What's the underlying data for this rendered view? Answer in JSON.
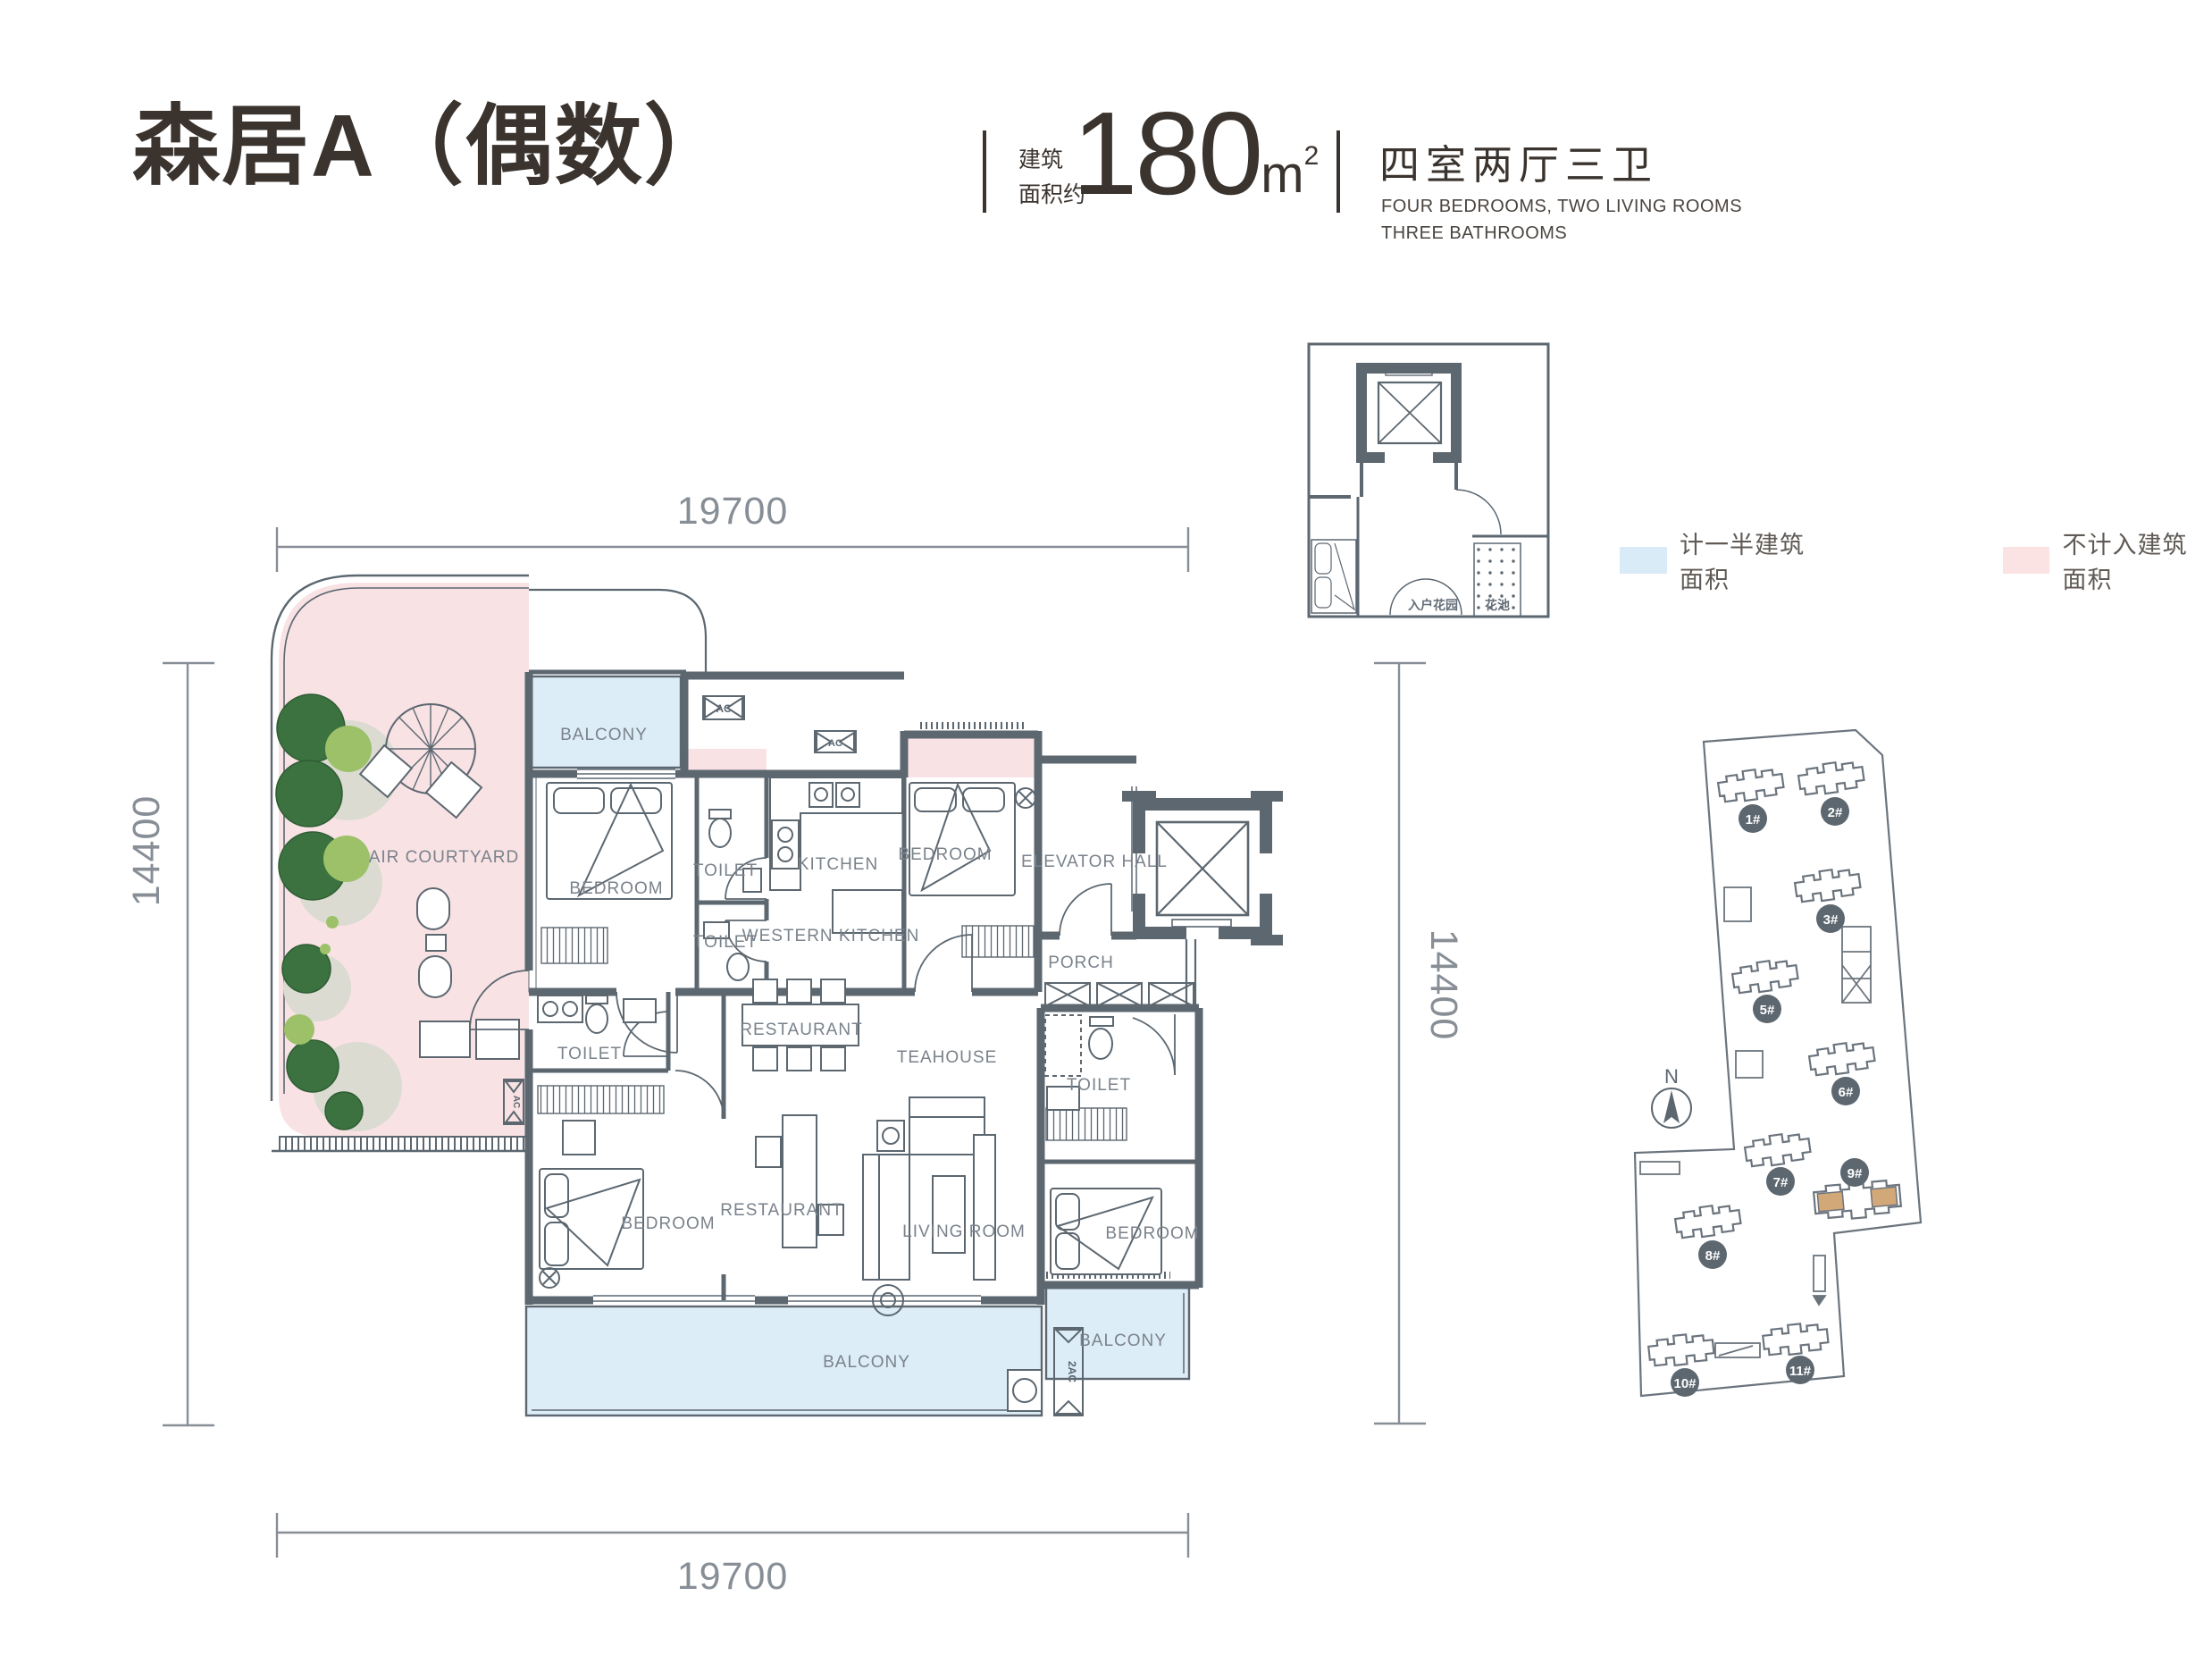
{
  "header": {
    "title": "森居A（偶数）",
    "area_label_line1": "建筑",
    "area_label_line2": "面积约",
    "area_value": "180",
    "area_unit": "m",
    "area_exponent": "2",
    "layout_cn": "四室两厅三卫",
    "layout_en_line1": "FOUR BEDROOMS, TWO LIVING ROOMS",
    "layout_en_line2": "THREE BATHROOMS"
  },
  "legend": {
    "half_area": {
      "label": "计一半建筑面积",
      "color": "#d9ebf7"
    },
    "excluded_area": {
      "label": "不计入建筑面积",
      "color": "#fbe3e4"
    }
  },
  "dimensions": {
    "top": "19700",
    "bottom": "19700",
    "left": "14400",
    "right": "14400"
  },
  "plan": {
    "balcony": "BALCONY",
    "air_courtyard": "AIR COURTYARD",
    "bedroom": "BEDROOM",
    "toilet": "TOILET",
    "kitchen": "KITCHEN",
    "western_kitchen": "WESTERN KITCHEN",
    "elevator_hall": "ELEVATOR HALL",
    "porch": "PORCH",
    "restaurant": "RESTAURANT",
    "teahouse": "TEAHOUSE",
    "living_room": "LIVING ROOM",
    "ac": "AC",
    "ac_vertical": "2AC"
  },
  "keyplan": {
    "entry_garden": "入户花园",
    "flower_bed": "花池"
  },
  "siteplan": {
    "north": "N",
    "buildings": [
      "1#",
      "2#",
      "3#",
      "5#",
      "6#",
      "7#",
      "8#",
      "9#",
      "10#",
      "11#"
    ],
    "highlight_color": "#d2a878"
  },
  "colors": {
    "wall": "#5c6770",
    "half_area_fill": "#ddedf8",
    "excluded_fill": "#f8e2e4",
    "tree_dark": "#3b7240",
    "tree_light": "#9cc168",
    "ground": "#dbdbd2",
    "title_text": "#3a332e",
    "label_text": "#7a828b"
  }
}
